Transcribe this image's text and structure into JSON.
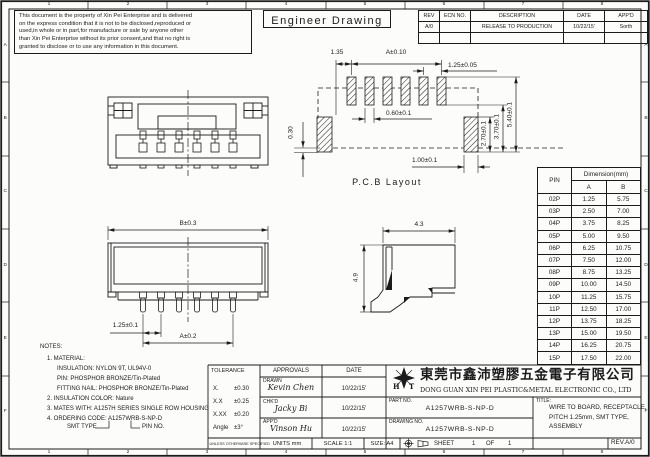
{
  "frame": {
    "cols": [
      "1",
      "2",
      "3",
      "4",
      "5",
      "6",
      "7",
      "8"
    ],
    "rows": [
      "A",
      "B",
      "C",
      "D",
      "E",
      "F"
    ]
  },
  "header": {
    "title": "Engineer Drawing",
    "disclaimer_lines": [
      "This document is the property of Xin Pei Enterprise and is delivered",
      "on the express condition that it is not to be disclosed,reproduced or",
      "used,in whole or in part,for manufacture or sale by anyone other",
      "than Xin Pei Enterprise without its prior consent,and that no right is",
      "granted to disclose or to use any information in this document."
    ]
  },
  "revision_table": {
    "headers": [
      "REV",
      "ECN NO.",
      "DESCRIPTION",
      "DATE",
      "APP'D"
    ],
    "row": {
      "rev": "A/0",
      "ecn": "",
      "description": "RELEASE TO PRODUCTION",
      "date": "10/22/15'",
      "appd": "Sorth"
    }
  },
  "pcb_view": {
    "label": "P.C.B Layout",
    "dim_135": "1.35",
    "dim_a": "A±0.10",
    "dim_125": "1.25±0.05",
    "dim_060": "0.60±0.1",
    "dim_030": "0.30",
    "dim_270": "2.70±0.1",
    "dim_370": "3.70±0.1",
    "dim_540": "5.40±0.1",
    "dim_100": "1.00±0.1"
  },
  "back_view": {
    "dim_b": "B±0.3",
    "dim_pitch": "1.25±0.1",
    "dim_a": "A±0.2"
  },
  "side_view": {
    "dim_w": "4.3",
    "dim_h": "4.9"
  },
  "pin_table": {
    "col_pin": "PIN",
    "col_dim": "Dimension(mm)",
    "col_a": "A",
    "col_b": "B",
    "rows": [
      {
        "pin": "02P",
        "a": "1.25",
        "b": "5.75"
      },
      {
        "pin": "03P",
        "a": "2.50",
        "b": "7.00"
      },
      {
        "pin": "04P",
        "a": "3.75",
        "b": "8.25"
      },
      {
        "pin": "05P",
        "a": "5.00",
        "b": "9.50"
      },
      {
        "pin": "06P",
        "a": "6.25",
        "b": "10.75"
      },
      {
        "pin": "07P",
        "a": "7.50",
        "b": "12.00"
      },
      {
        "pin": "08P",
        "a": "8.75",
        "b": "13.25"
      },
      {
        "pin": "09P",
        "a": "10.00",
        "b": "14.50"
      },
      {
        "pin": "10P",
        "a": "11.25",
        "b": "15.75"
      },
      {
        "pin": "11P",
        "a": "12.50",
        "b": "17.00"
      },
      {
        "pin": "12P",
        "a": "13.75",
        "b": "18.25"
      },
      {
        "pin": "13P",
        "a": "15.00",
        "b": "19.50"
      },
      {
        "pin": "14P",
        "a": "16.25",
        "b": "20.75"
      },
      {
        "pin": "15P",
        "a": "17.50",
        "b": "22.00"
      }
    ]
  },
  "notes": {
    "heading": "NOTES:",
    "lines": [
      "1. MATERIAL:",
      "INSULATION: NYLON 9T, UL94V-0",
      "PIN: PHOSPHOR BRONZE/Tin-Plated",
      "FITTING NAIL: PHOSPHOR BRONZE/Tin-Plated",
      "2. INSULATION COLOR: Nature",
      "3. MATES WITH: A1257H SERIES SINGLE ROW HOUSING",
      "4. ORDERING CODE: A1257WRB-S-NP-D"
    ],
    "code_annotation_left": "SMT TYPE",
    "code_annotation_right": "PIN NO."
  },
  "title_block": {
    "tolerance": {
      "heading": "TOLERANCE",
      "rows": [
        {
          "label": "X.",
          "value": "±0.30"
        },
        {
          "label": "X.X",
          "value": "±0.25"
        },
        {
          "label": "X.XX",
          "value": "±0.20"
        },
        {
          "label": "Angle",
          "value": "±3°"
        }
      ],
      "footnote": "UNLESS OTHERWISE SPECIFIED"
    },
    "approvals": {
      "heading": "APPROVALS",
      "date_heading": "DATE",
      "rows": [
        {
          "role": "DRAWN",
          "name": "Kevin Chen",
          "date": "10/22/15'"
        },
        {
          "role": "CHK'D",
          "name": "Jacky Bi",
          "date": "10/22/15'"
        },
        {
          "role": "APP'D",
          "name": "Vinson Hu",
          "date": "10/22/15'"
        }
      ]
    },
    "units": "UNITS  mm",
    "scale": "SCALE   1:1",
    "size": "SIZE: A4",
    "company": {
      "logo_left": "H",
      "logo_right": "T",
      "name_cn": "東莞市鑫沛塑膠五金電子有限公司",
      "name_en": "DONG GUAN XIN PEI PLASTIC&METAL ELECTRONIC CO., LTD"
    },
    "part_no": {
      "label": "PART NO.",
      "value": "A1257WRB-S-NP-D"
    },
    "drawing_no": {
      "label": "DRAWING NO.",
      "value": "A1257WRB-S-NP-D"
    },
    "sheet": {
      "label": "SHEET",
      "num": "1",
      "of": "OF",
      "total": "1"
    },
    "title": {
      "label": "TITLE:",
      "lines": [
        "WIRE TO BOARD, RECEPTACLE,",
        "PITCH 1.25mm, SMT TYPE,",
        "ASSEMBLY"
      ]
    },
    "rev": "REV.A/0"
  }
}
